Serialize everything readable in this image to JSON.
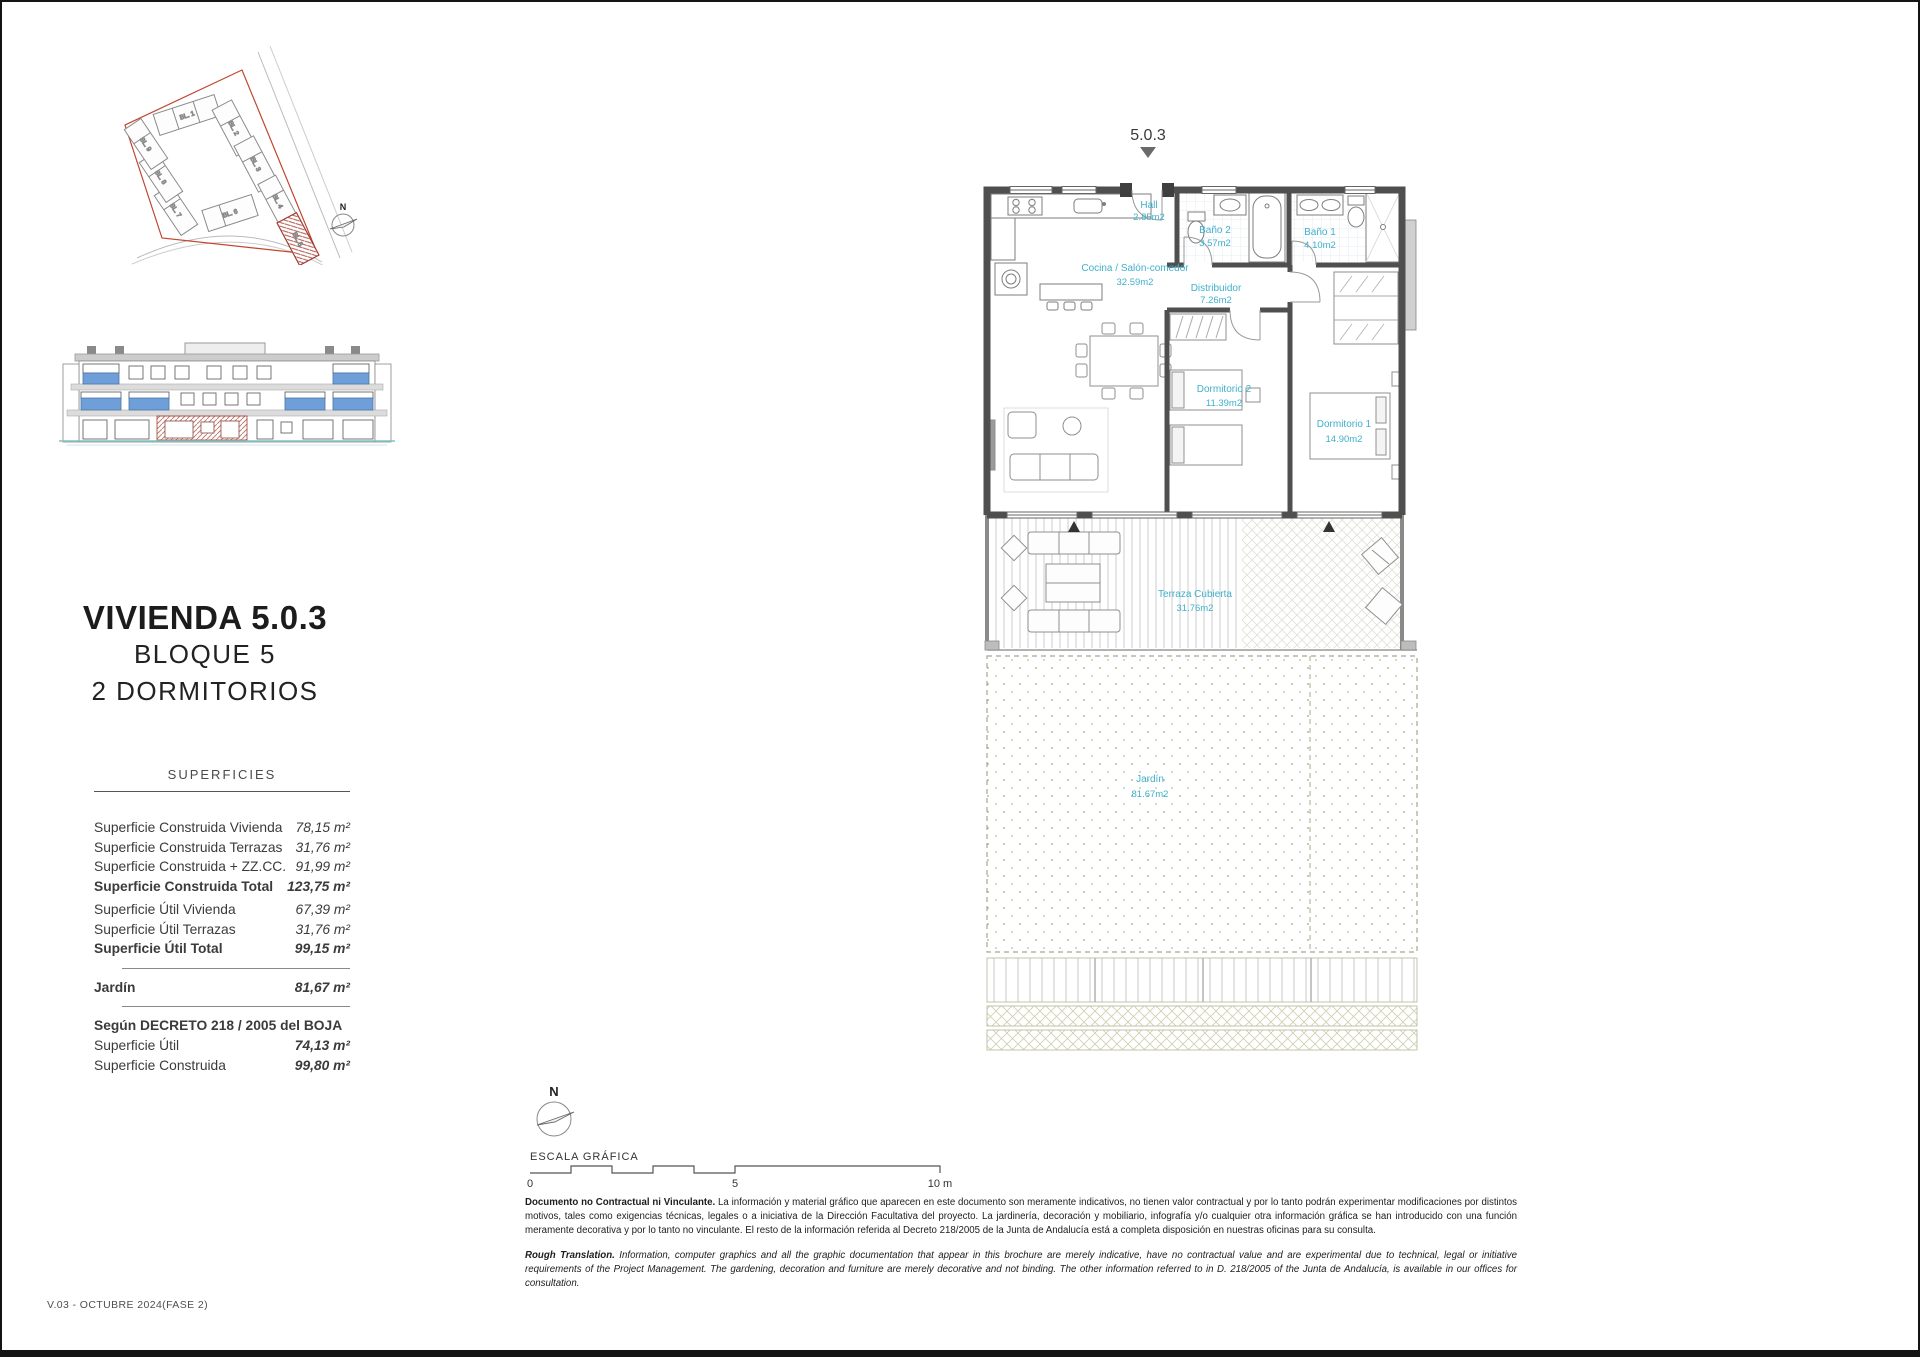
{
  "title": {
    "main": "VIVIENDA 5.0.3",
    "block": "BLOQUE 5",
    "bedrooms": "2 DORMITORIOS"
  },
  "surfaces": {
    "header": "SUPERFICIES",
    "rows": [
      {
        "label": "Superficie Construida Vivienda",
        "value": "78,15 m²"
      },
      {
        "label": "Superficie Construida Terrazas",
        "value": "31,76 m²"
      },
      {
        "label": "Superficie Construida + ZZ.CC.",
        "value": "91,99 m²"
      },
      {
        "label": "Superficie Construida Total",
        "value": "123,75 m²"
      },
      {
        "label": "Superficie Útil Vivienda",
        "value": "67,39 m²"
      },
      {
        "label": "Superficie Útil Terrazas",
        "value": "31,76 m²"
      },
      {
        "label": "Superficie Útil Total",
        "value": "99,15 m²"
      },
      {
        "label": "Jardín",
        "value": "81,67 m²"
      }
    ],
    "decreto": {
      "header": "Según DECRETO 218 / 2005 del BOJA",
      "rows": [
        {
          "label": "Superficie Útil",
          "value": "74,13 m²"
        },
        {
          "label": "Superficie Construida",
          "value": "99,80 m²"
        }
      ]
    }
  },
  "siteplan": {
    "north_label": "N",
    "highlighted_block": "BL. 5",
    "blocks": [
      {
        "label": "BL. 1"
      },
      {
        "label": "BL. 2"
      },
      {
        "label": "BL. 3"
      },
      {
        "label": "BL. 4"
      },
      {
        "label": "BL. 5"
      },
      {
        "label": "BL. 6"
      },
      {
        "label": "BL. 7"
      },
      {
        "label": "BL. 8"
      },
      {
        "label": "BL. 9"
      }
    ]
  },
  "plan": {
    "unit_label": "5.0.3",
    "rooms": {
      "hall": {
        "name": "Hall",
        "area": "2.85m2"
      },
      "kitchen": {
        "name": "Cocina / Salón-comedor",
        "area": "32.59m2"
      },
      "bath2": {
        "name": "Baño 2",
        "area": "3.57m2"
      },
      "bath1": {
        "name": "Baño 1",
        "area": "4.10m2"
      },
      "hallway": {
        "name": "Distribuidor",
        "area": "7.26m2"
      },
      "bedroom2": {
        "name": "Dormitorio 2",
        "area": "11.39m2"
      },
      "bedroom1": {
        "name": "Dormitorio 1",
        "area": "14.90m2"
      },
      "terrace": {
        "name": "Terraza Cubierta",
        "area": "31.76m2"
      },
      "garden": {
        "name": "Jardín",
        "area": "81.67m2"
      }
    }
  },
  "scale": {
    "north_label": "N",
    "title": "ESCALA GRÁFICA",
    "ticks": [
      "0",
      "5",
      "10 m"
    ]
  },
  "disclaimer": {
    "es_lead": "Documento no Contractual ni Vinculante.",
    "es_body": "La información y material gráfico que aparecen en este documento son meramente indicativos, no tienen valor contractual y por lo tanto podrán experimentar modificaciones por distintos motivos, tales como exigencias técnicas, legales o a iniciativa de la Dirección Facultativa del proyecto. La jardinería, decoración y mobiliario, infografía y/o cualquier otra información gráfica se han introducido con una función meramente decorativa y por lo tanto no vinculante. El resto de la información referida al Decreto 218/2005 de la Junta de Andalucía está a completa disposición en nuestras oficinas para su consulta.",
    "en_lead": "Rough Translation.",
    "en_body": "Information, computer graphics and all the graphic documentation that appear in this brochure are merely indicative, have no contractual value and are experimental due to technical, legal or initiative requirements of the Project Management. The gardening, decoration and furniture are merely decorative and not binding. The other information referred to in D. 218/2005 of the Junta de Andalucía, is available in our offices for consultation."
  },
  "footer": {
    "version": "V.03 - OCTUBRE 2024(FASE 2)"
  },
  "colors": {
    "accent_red": "#c0462e",
    "label_cyan": "#3fb0ca",
    "window_blue": "#6f9fd8",
    "ground_teal": "#7fc4c4",
    "wall_gray": "#4f4f4f"
  }
}
